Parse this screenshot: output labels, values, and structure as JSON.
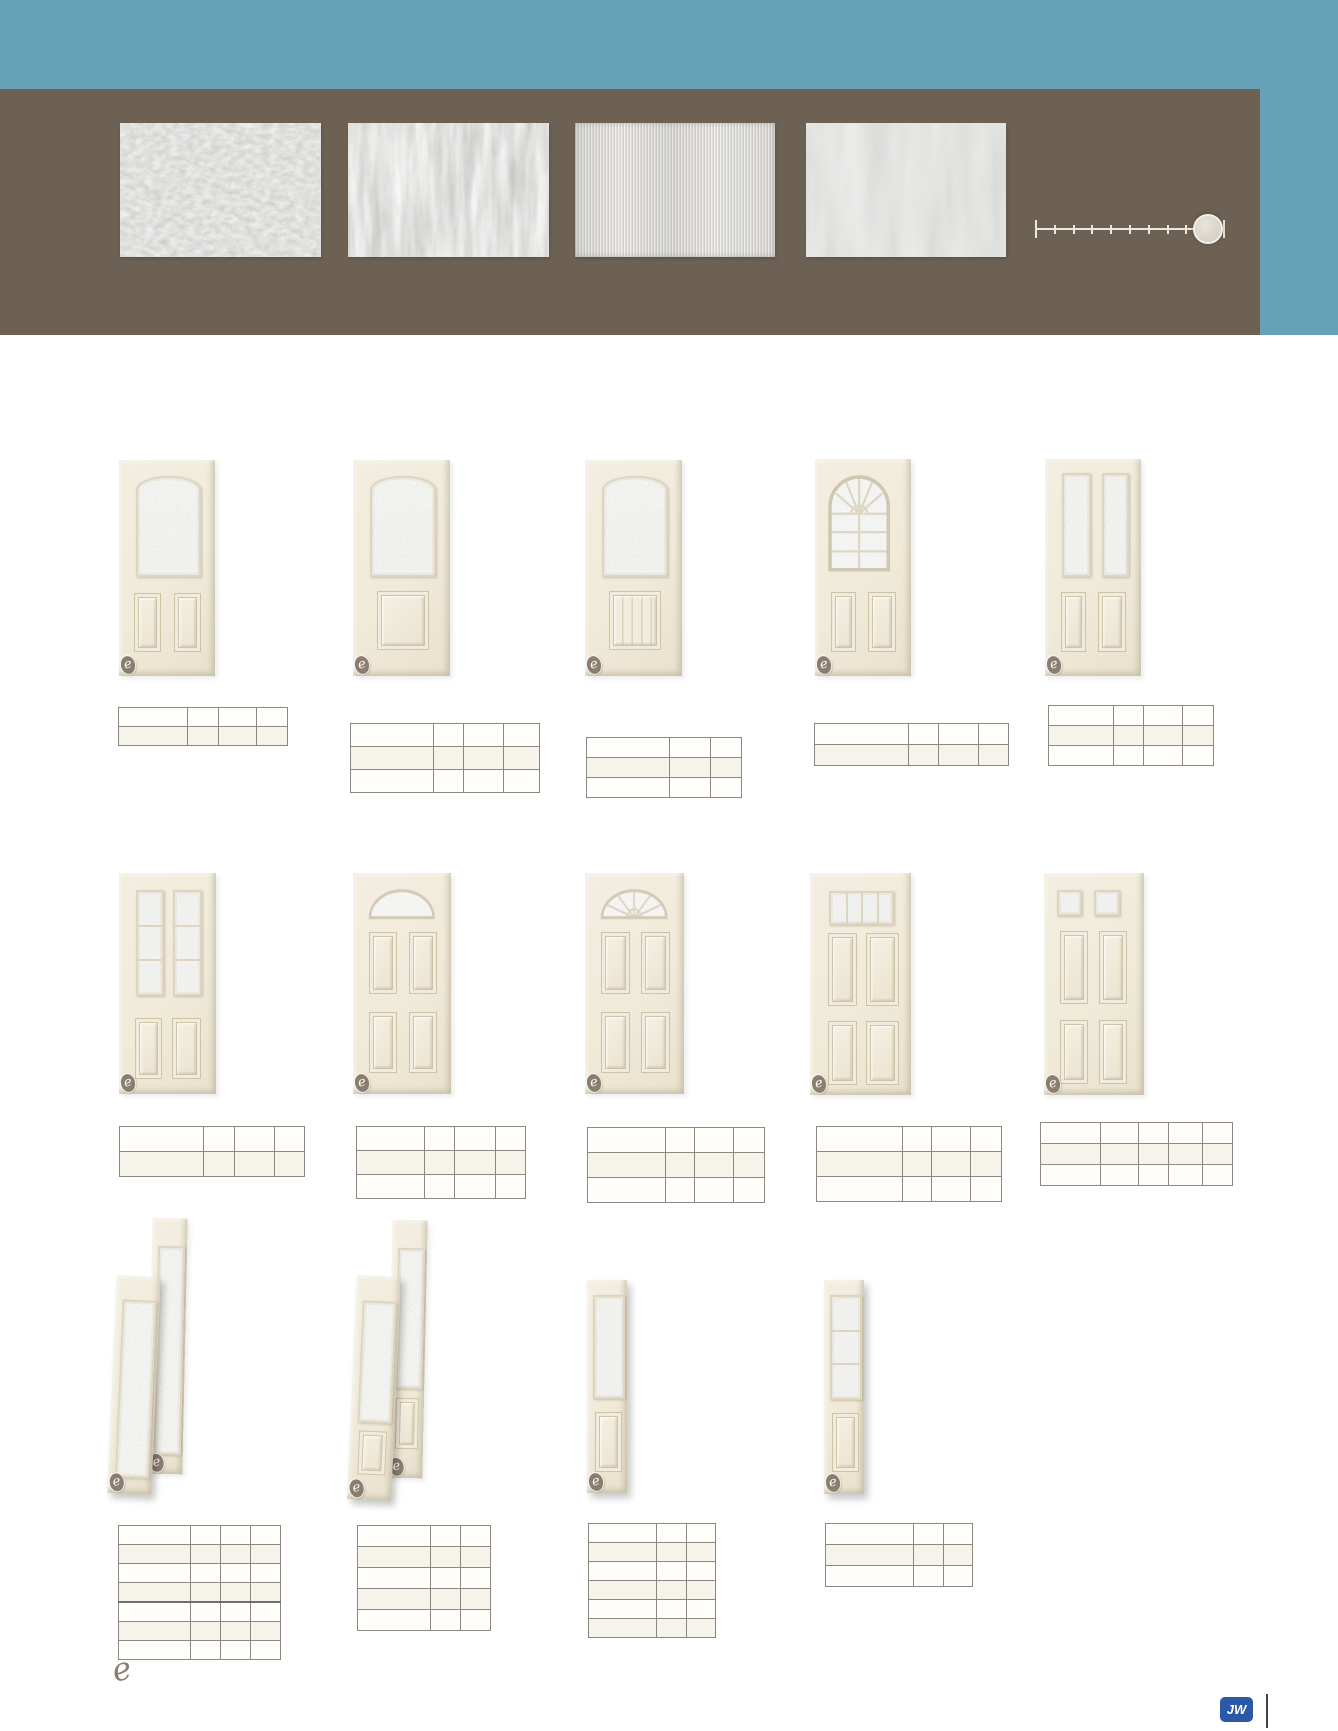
{
  "page": {
    "header": {
      "teal_color": "#67a1b7",
      "brown_color": "#6d6154",
      "teal_band": {
        "x": 0,
        "y": 0,
        "w": 1338,
        "h": 335
      },
      "brown_band": {
        "x": 0,
        "y": 89,
        "w": 1260,
        "h": 246
      }
    },
    "glass_swatches": [
      {
        "name": "crinkle-glass-swatch",
        "texture": "crinkle",
        "x": 120,
        "y": 123,
        "w": 201,
        "h": 134
      },
      {
        "name": "streak-glass-swatch",
        "texture": "streaks",
        "x": 348,
        "y": 123,
        "w": 201,
        "h": 134
      },
      {
        "name": "reed-glass-swatch",
        "texture": "reed",
        "x": 575,
        "y": 123,
        "w": 200,
        "h": 134
      },
      {
        "name": "wave-glass-swatch",
        "texture": "wave",
        "x": 806,
        "y": 123,
        "w": 200,
        "h": 134
      }
    ],
    "privacy_scale": {
      "x": 1036,
      "y": 213,
      "length": 188,
      "ticks": 11,
      "knob_center": 170,
      "knob_size": 26
    },
    "badge_letter": "e",
    "footer": {
      "e_logo_text": "e",
      "jw_logo_text": "JW"
    }
  },
  "doors": [
    {
      "style": "half-lite-2panel",
      "x": 119,
      "y": 460,
      "w": 96,
      "h": 216
    },
    {
      "style": "half-lite-1panel",
      "x": 353,
      "y": 460,
      "w": 97,
      "h": 216
    },
    {
      "style": "half-lite-plank",
      "x": 585,
      "y": 460,
      "w": 97,
      "h": 216
    },
    {
      "style": "arch-grille-2panel",
      "x": 815,
      "y": 459,
      "w": 96,
      "h": 217
    },
    {
      "style": "twin-lite-2panel",
      "x": 1045,
      "y": 459,
      "w": 96,
      "h": 217
    },
    {
      "style": "twin-lite-3seg-2panel",
      "x": 119,
      "y": 873,
      "w": 97,
      "h": 221
    },
    {
      "style": "fan-4panel",
      "x": 353,
      "y": 873,
      "w": 98,
      "h": 221
    },
    {
      "style": "fan-sunburst-4panel",
      "x": 585,
      "y": 873,
      "w": 99,
      "h": 221
    },
    {
      "style": "strip-lite-4panel",
      "x": 810,
      "y": 873,
      "w": 101,
      "h": 222
    },
    {
      "style": "twin-square-4panel",
      "x": 1044,
      "y": 873,
      "w": 100,
      "h": 222
    }
  ],
  "sidelites": [
    {
      "style": "full-lite",
      "x": 150,
      "y": 1218,
      "w": 35,
      "h": 256,
      "tilt": 1.2,
      "front": false
    },
    {
      "style": "full-lite",
      "x": 112,
      "y": 1276,
      "w": 44,
      "h": 218,
      "tilt": 2.5,
      "front": true
    },
    {
      "style": "lite-bottom-panel",
      "x": 390,
      "y": 1220,
      "w": 35,
      "h": 258,
      "tilt": 1.2,
      "front": false
    },
    {
      "style": "lite-bottom-panel",
      "x": 352,
      "y": 1276,
      "w": 44,
      "h": 224,
      "tilt": 2.5,
      "front": true
    },
    {
      "style": "half-lite-panel",
      "x": 587,
      "y": 1280,
      "w": 40,
      "h": 213,
      "tilt": 0,
      "front": true
    },
    {
      "style": "lite-3seg-panel",
      "x": 824,
      "y": 1280,
      "w": 40,
      "h": 214,
      "tilt": 0,
      "front": true
    }
  ],
  "tables": [
    {
      "x": 118,
      "y": 707,
      "rows": 2,
      "row_h": 18,
      "cols": [
        69,
        31,
        38,
        31
      ]
    },
    {
      "x": 350,
      "y": 723,
      "rows": 3,
      "row_h": 22,
      "cols": [
        83,
        30,
        40,
        36
      ]
    },
    {
      "x": 586,
      "y": 737,
      "rows": 3,
      "row_h": 19,
      "cols": [
        83,
        41,
        31
      ]
    },
    {
      "x": 814,
      "y": 723,
      "rows": 2,
      "row_h": 20,
      "cols": [
        94,
        30,
        40,
        30
      ]
    },
    {
      "x": 1048,
      "y": 705,
      "rows": 3,
      "row_h": 19,
      "cols": [
        65,
        30,
        39,
        31
      ]
    },
    {
      "x": 119,
      "y": 1126,
      "rows": 2,
      "row_h": 24,
      "cols": [
        84,
        31,
        40,
        30
      ]
    },
    {
      "x": 356,
      "y": 1126,
      "rows": 3,
      "row_h": 23,
      "cols": [
        68,
        30,
        41,
        30
      ]
    },
    {
      "x": 587,
      "y": 1127,
      "rows": 3,
      "row_h": 24,
      "cols": [
        78,
        29,
        39,
        31
      ]
    },
    {
      "x": 816,
      "y": 1126,
      "rows": 3,
      "row_h": 24,
      "cols": [
        86,
        29,
        39,
        31
      ]
    },
    {
      "x": 1040,
      "y": 1122,
      "rows": 3,
      "row_h": 20,
      "cols": [
        60,
        38,
        30,
        34,
        30
      ]
    },
    {
      "x": 118,
      "y": 1525,
      "rows": 7,
      "row_h": 18,
      "cols": [
        72,
        30,
        30,
        30
      ],
      "thick_after_row": 4
    },
    {
      "x": 357,
      "y": 1525,
      "rows": 5,
      "row_h": 20,
      "cols": [
        73,
        30,
        30
      ]
    },
    {
      "x": 588,
      "y": 1523,
      "rows": 6,
      "row_h": 18,
      "cols": [
        68,
        30,
        29
      ]
    },
    {
      "x": 825,
      "y": 1523,
      "rows": 3,
      "row_h": 20,
      "cols": [
        88,
        30,
        29
      ]
    }
  ]
}
